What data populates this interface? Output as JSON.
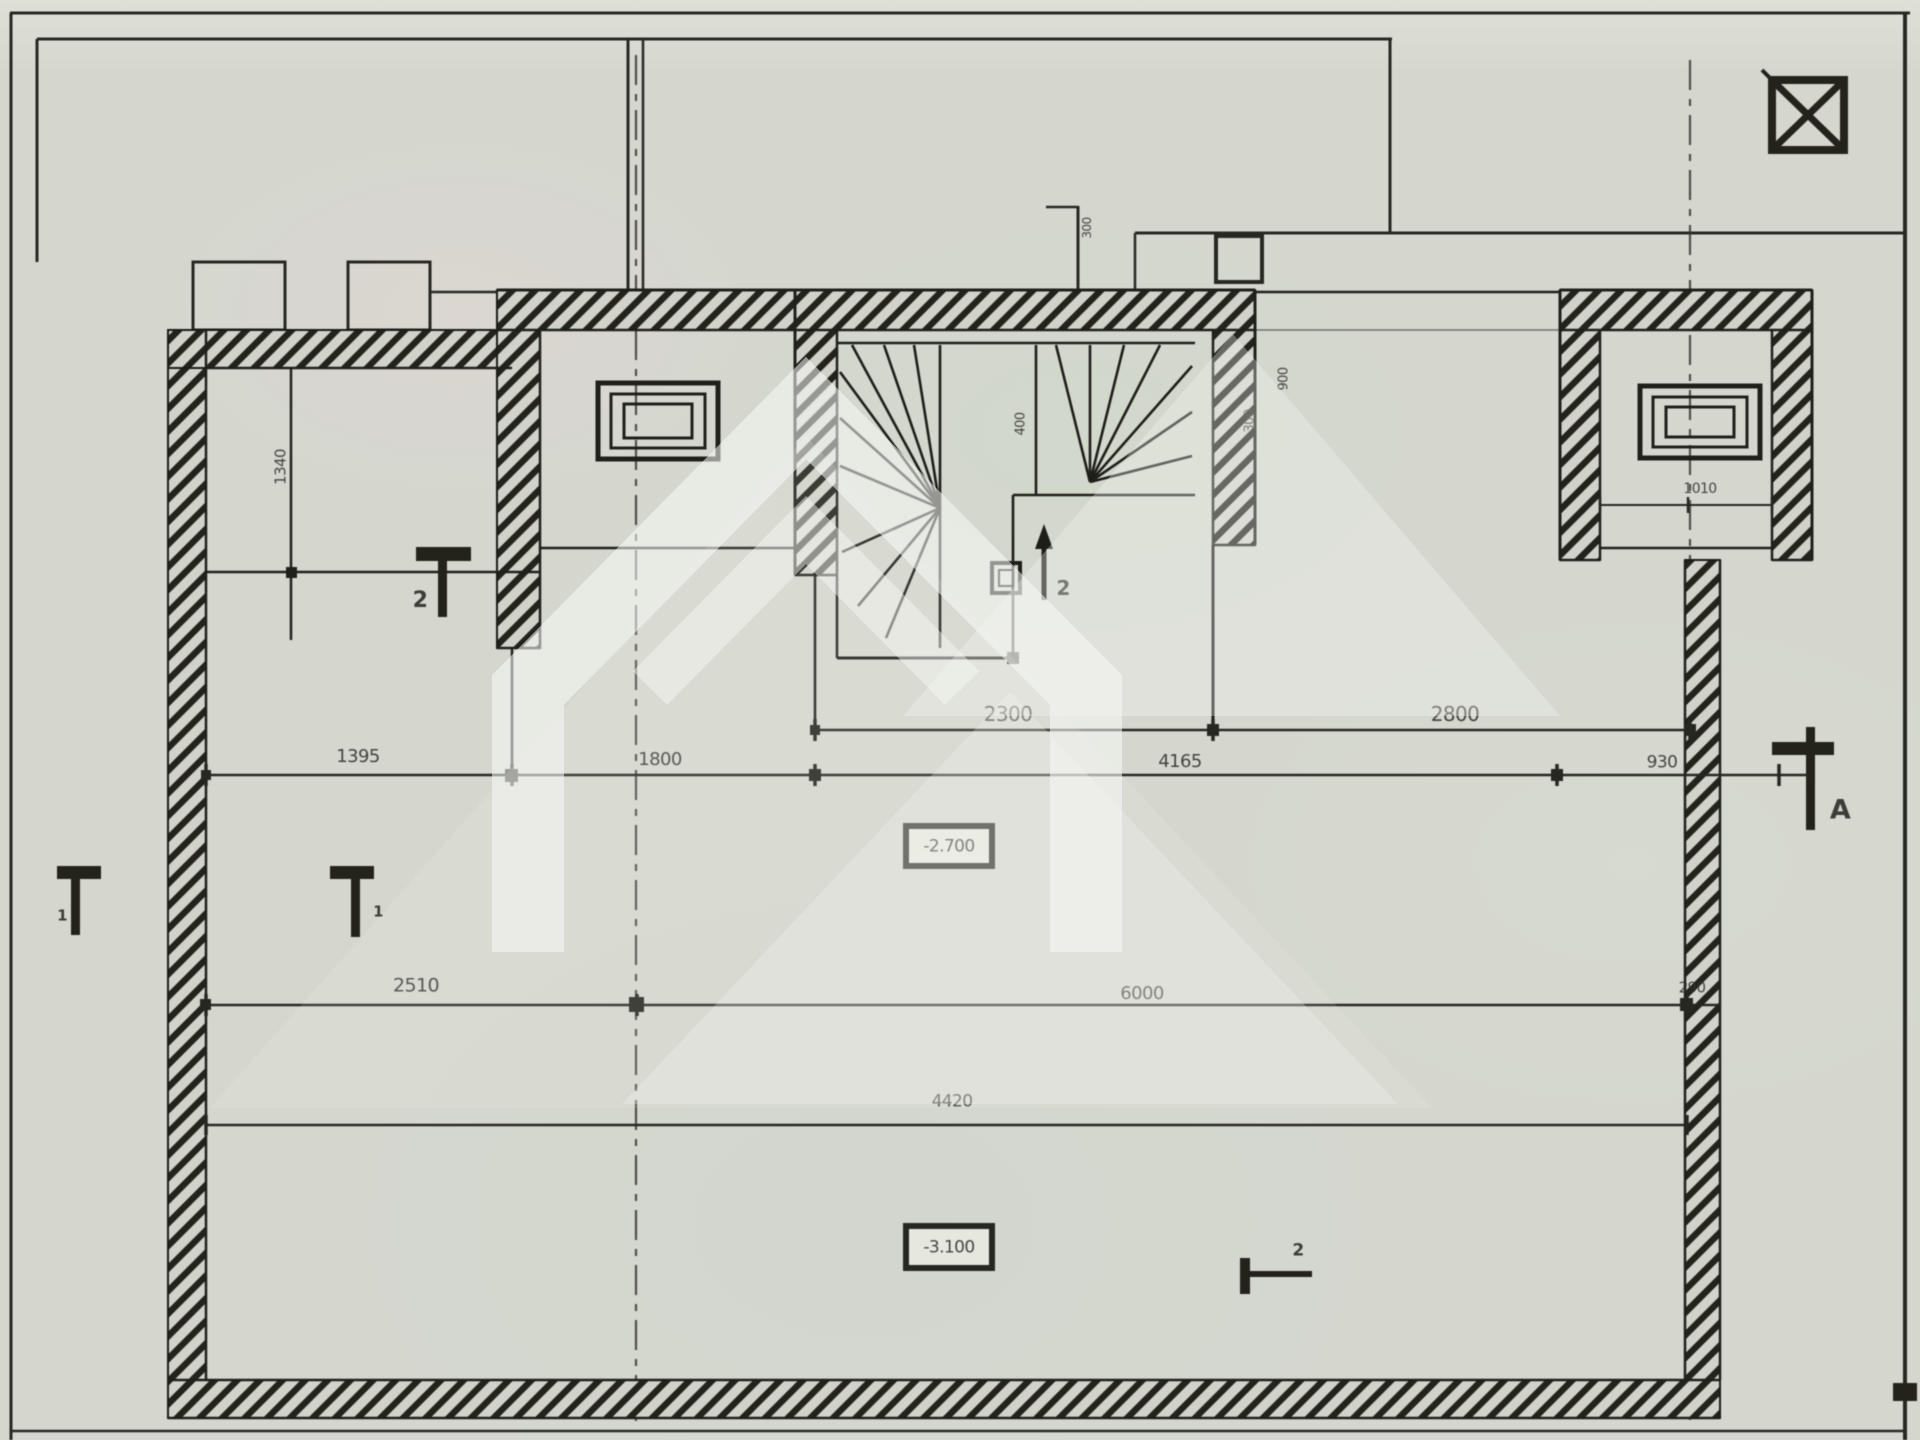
{
  "drawing": {
    "kind": "scanned basement floor plan with winder staircase",
    "dims": {
      "row1": [
        "2300",
        "2800"
      ],
      "row2": [
        "1395",
        "1800",
        "4165",
        "930"
      ],
      "row3": [
        "2510",
        "6000",
        "290"
      ],
      "row4": [
        "4420"
      ],
      "small": [
        "1340",
        "400",
        "300",
        "900",
        "300",
        "1010"
      ]
    },
    "levels": {
      "upper": "-2.700",
      "lower": "-3.100"
    },
    "markers": {
      "section1_left": "1",
      "section1_right": "1",
      "section2_upper": "2",
      "stair_arrow": "2",
      "axis_a": "A",
      "section2_lower": "2"
    },
    "symbols": {
      "top_right": "crossed-box shaft symbol"
    }
  },
  "colors": {
    "paper": "#d5d7cf",
    "ink": "#26261f",
    "watermark": "rgba(248,249,245,0.5)"
  }
}
